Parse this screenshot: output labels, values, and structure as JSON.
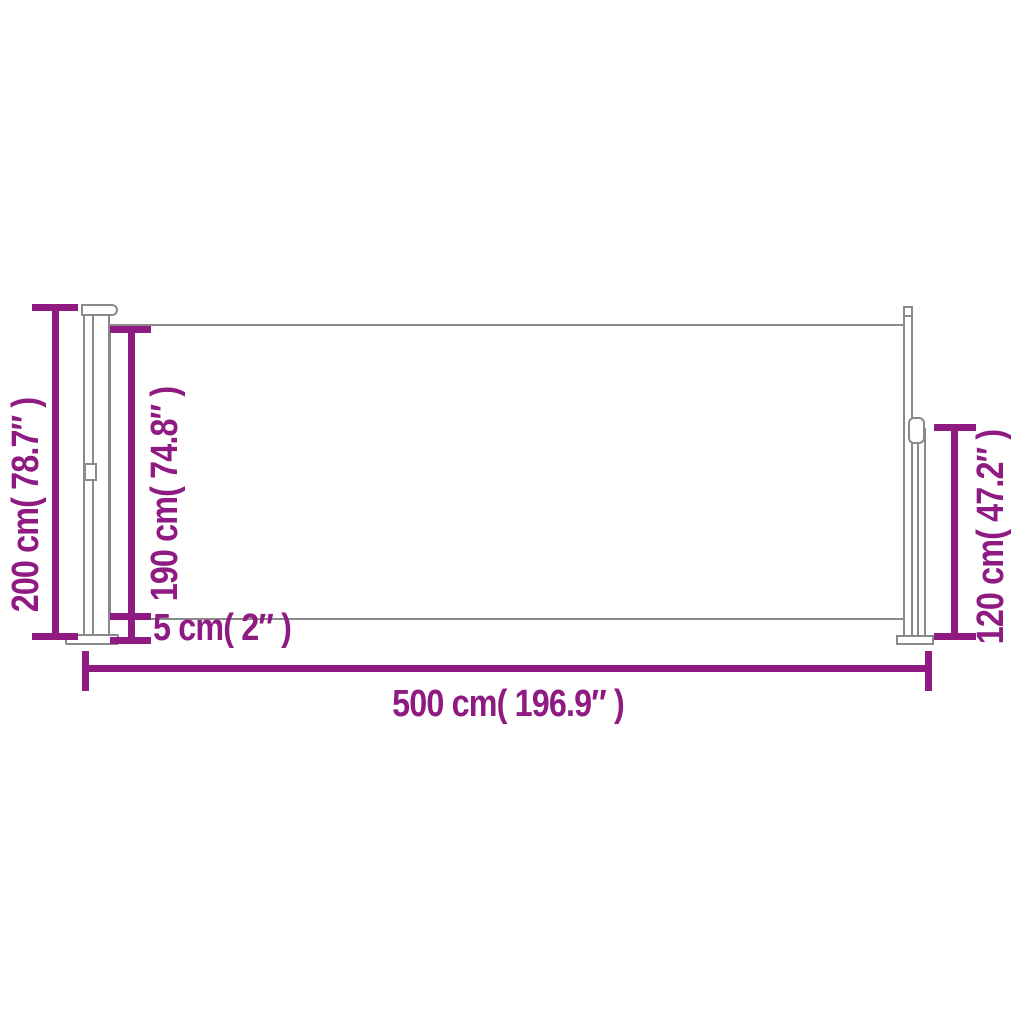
{
  "colors": {
    "accent": "#8e1a82",
    "outline": "#8a8a8a",
    "fill": "#ffffff",
    "background": "#ffffff"
  },
  "dimensions": {
    "total_height": {
      "label": "200 cm( 78.7″ )"
    },
    "fabric_height": {
      "label": "190 cm( 74.8″ )"
    },
    "ground_gap": {
      "label": "5 cm( 2″ )"
    },
    "total_length": {
      "label": "500 cm( 196.9″ )"
    },
    "pole_height": {
      "label": "120 cm( 47.2″ )"
    }
  }
}
